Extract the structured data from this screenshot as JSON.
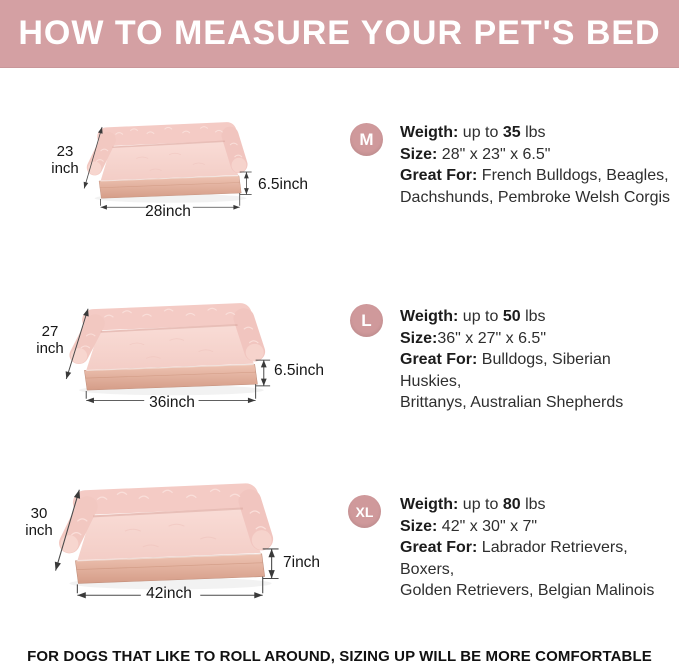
{
  "header": {
    "title": "HOW TO MEASURE YOUR PET'S BED"
  },
  "sizes": [
    {
      "badge": "M",
      "weight": {
        "label": "Weigth:",
        "mid": " up to ",
        "value": "35",
        "unit": " lbs"
      },
      "size": {
        "label": "Size:",
        "value": " 28\" x 23\" x 6.5\""
      },
      "great": {
        "label": "Great For:",
        "line1": " French Bulldogs, Beagles,",
        "line2": "Dachshunds, Pembroke Welsh Corgis"
      },
      "dims": {
        "depth_value": "23",
        "depth_unit": "inch",
        "width": "28inch",
        "height": "6.5inch"
      }
    },
    {
      "badge": "L",
      "weight": {
        "label": "Weigth:",
        "mid": " up to ",
        "value": "50",
        "unit": " lbs"
      },
      "size": {
        "label": "Size:",
        "value": "36\" x 27\" x 6.5\""
      },
      "great": {
        "label": "Great For:",
        "line1": " Bulldogs, Siberian Huskies,",
        "line2": "Brittanys, Australian Shepherds"
      },
      "dims": {
        "depth_value": "27",
        "depth_unit": "inch",
        "width": "36inch",
        "height": "6.5inch"
      }
    },
    {
      "badge": "XL",
      "weight": {
        "label": "Weigth:",
        "mid": " up to ",
        "value": "80",
        "unit": " lbs"
      },
      "size": {
        "label": "Size:",
        "value": " 42\" x 30\" x 7\""
      },
      "great": {
        "label": "Great For:",
        "line1": " Labrador Retrievers, Boxers,",
        "line2": "Golden Retrievers, Belgian Malinois"
      },
      "dims": {
        "depth_value": "30",
        "depth_unit": "inch",
        "width": "42inch",
        "height": "7inch"
      }
    }
  ],
  "footer": {
    "note": "FOR DOGS THAT LIKE TO ROLL AROUND, SIZING UP WILL BE MORE COMFORTABLE"
  },
  "colors": {
    "header_bg": "#d4a0a3",
    "badge_bg": "#cf999b",
    "bolster_pink": "#f4cbc5",
    "mattress_pink": "#f8dad6",
    "base_tan": "#e2ae9b",
    "dimension_line": "#4a4a4a"
  }
}
